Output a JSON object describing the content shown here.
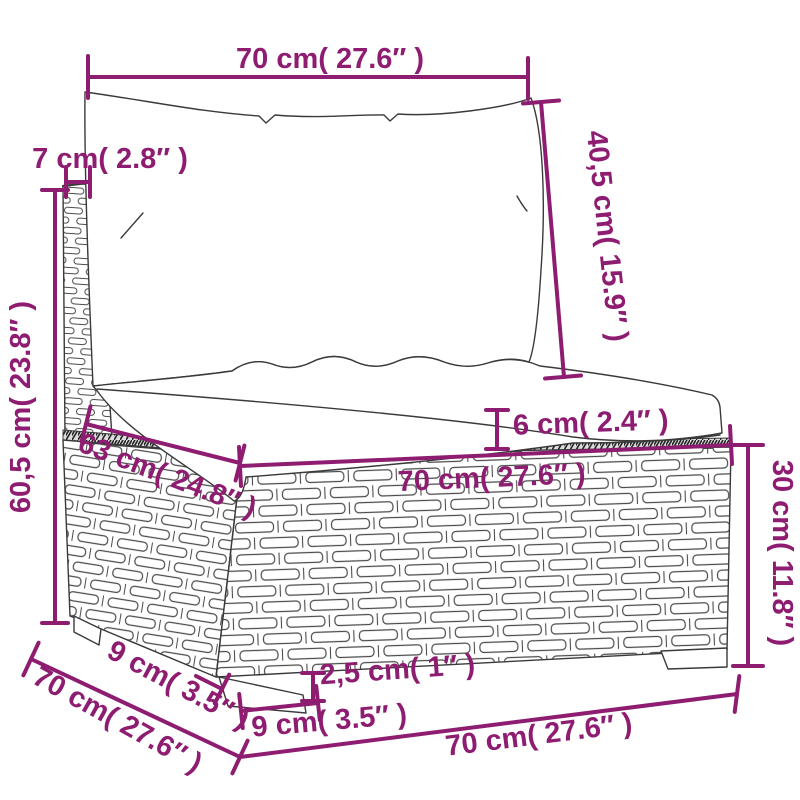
{
  "figure": {
    "type": "product-dimension-diagram",
    "subject": "poly-rattan modular sofa middle section with back and seat cushions",
    "accent_color": "#8e1d71",
    "line_color": "#3a3a3a",
    "background": "#ffffff"
  },
  "dimensions": {
    "top_width": "70 cm( 27.6″ )",
    "back_cushion_height": "40,5 cm( 15.9″ )",
    "back_panel_thickness": "7 cm( 2.8″ )",
    "total_height": "60,5 cm( 23.8″ )",
    "seat_cushion_thickness": "6 cm( 2.4″ )",
    "seat_depth": "63 cm( 24.8″ )",
    "seat_width": "70 cm( 27.6″ )",
    "base_height": "30 cm( 11.8″ )",
    "depth_total": "70 cm( 27.6″ )",
    "foot_depth": "9 cm( 3.5″ )",
    "foot_height": "2,5 cm( 1″ )",
    "foot_width": "9 cm( 3.5″ )",
    "bottom_width": "70 cm( 27.6″ )"
  }
}
